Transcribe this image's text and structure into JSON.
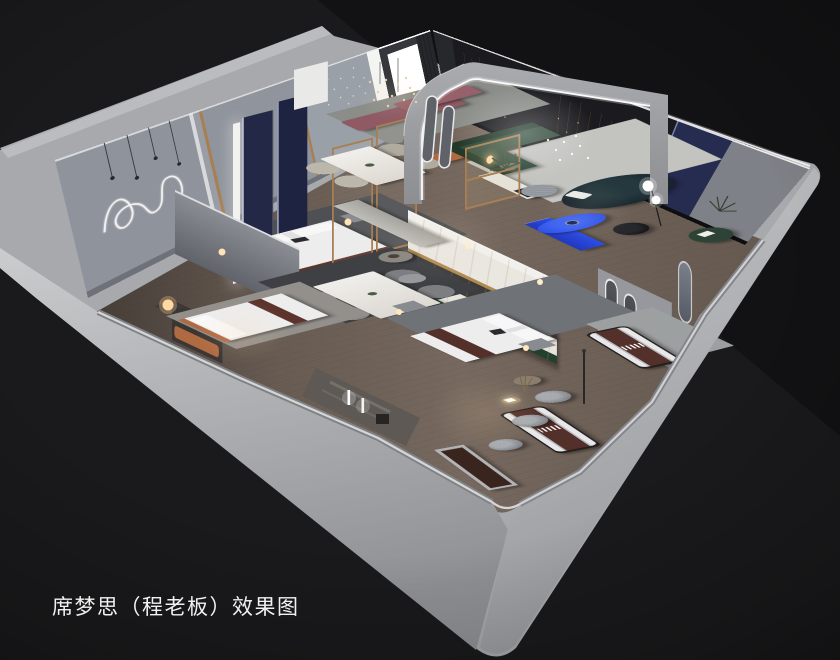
{
  "caption": {
    "text": "席梦思（程老板）效果图"
  },
  "scene": {
    "type": "3d-interior-render",
    "subject": "mattress showroom isometric cutaway floor plan",
    "zones": [
      "bedroom-display-left",
      "dining-display",
      "center-bedroom-display",
      "arched-lounge",
      "mattress-gallery",
      "front-wall-display-niche"
    ]
  },
  "palette": {
    "bg": "#1a1a1c",
    "bgDeep": "#121214",
    "shell": "#a7a9ad",
    "bandLight": "#cbccce",
    "bandMid": "#8e9093",
    "wallInner": "#999da5",
    "wallDark": "#1b1b1f",
    "floor": "#77695f",
    "floorDark": "#594f47",
    "rugLight": "#c3c4c0",
    "rugDark": "#3e4044",
    "marble": "#eae7e1",
    "gold": "#b08a50",
    "navy": "#222845",
    "blue": "#2d4fe4",
    "greenSofa": "#2f4a3a",
    "tealSofa": "#15232b",
    "mauve": "#8f5a64",
    "orange": "#b06a42",
    "bedWhite": "#ededee",
    "mattressBrown": "#53302a",
    "woodFrame": "#a87f52",
    "led": "#ffffff"
  }
}
